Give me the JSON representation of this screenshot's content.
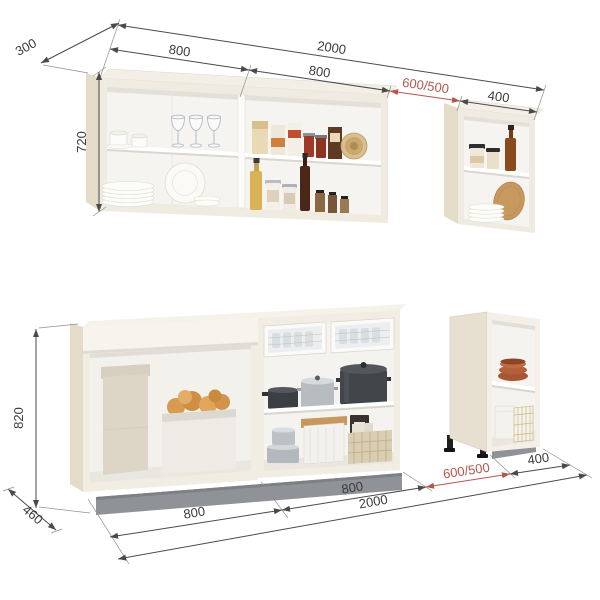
{
  "dimensions": {
    "upper": {
      "depth": "300",
      "width_section_1": "800",
      "width_total": "2000",
      "width_section_2": "800",
      "gap": "600/500",
      "width_small": "400",
      "height": "720"
    },
    "lower": {
      "height": "820",
      "depth": "460",
      "width_section_1": "800",
      "width_total": "2000",
      "width_section_2": "800",
      "gap": "600/500",
      "width_small": "400"
    }
  },
  "colors": {
    "dimension_line": "#4a4a4a",
    "dimension_text": "#3b3b3b",
    "gap_dimension_text": "#b5564c",
    "cabinet_front": "#f0ebe1",
    "cabinet_side": "#e4dbc9",
    "plinth_gray": "#8f9296",
    "background": "#ffffff"
  },
  "scene": {
    "upper_row": [
      "two-section-wall-cabinet",
      "small-wall-cabinet"
    ],
    "lower_row": [
      "open-base-cabinet",
      "drawer-shelf-base-cabinet",
      "small-open-base-cabinet"
    ]
  }
}
